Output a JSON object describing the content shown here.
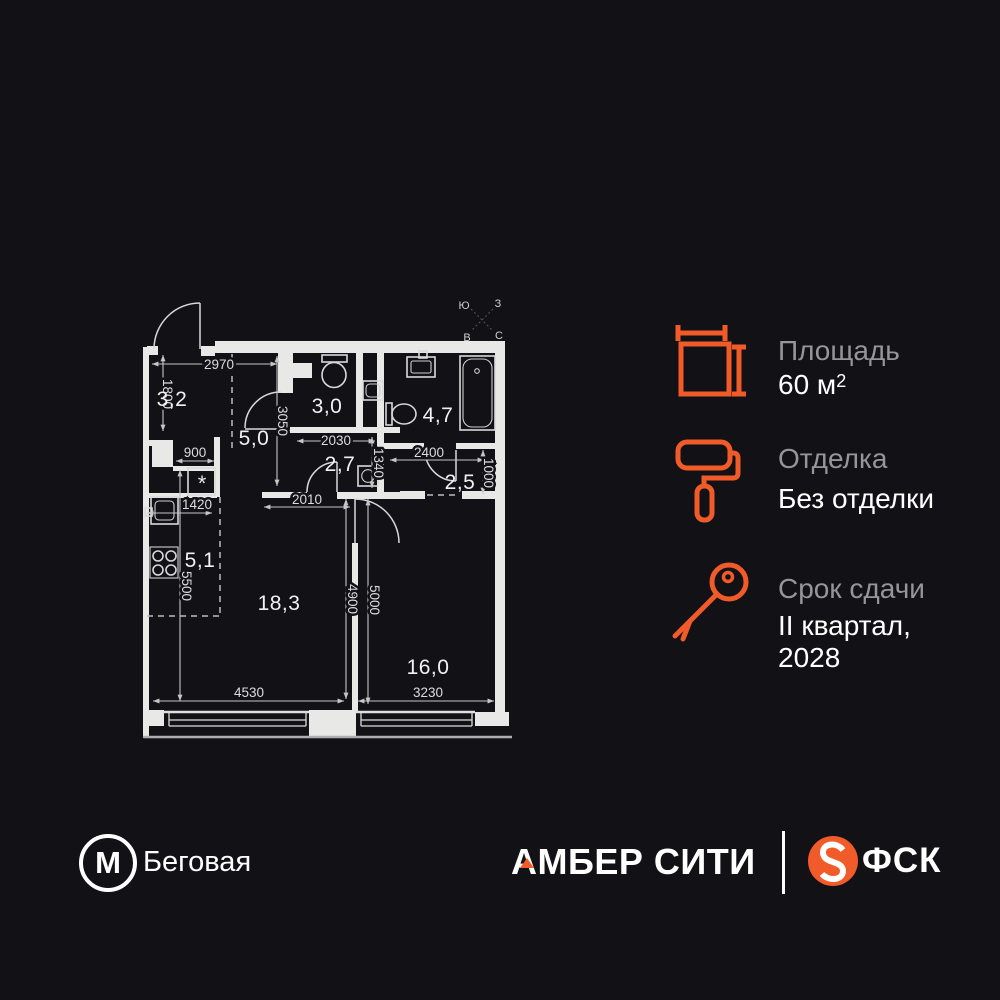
{
  "colors": {
    "accent": "#F15A29",
    "background": "#121116",
    "plan_line": "#E8E8E6",
    "label_gray": "#95959B",
    "text_white": "#FFFFFF"
  },
  "plan": {
    "compass": {
      "top_left": "Ю",
      "top_right": "З",
      "bottom_left": "В",
      "bottom_right": "С"
    },
    "rooms": {
      "entry": "3,2",
      "hallway": "5,0",
      "wc": "3,0",
      "bathroom": "4,7",
      "wardrobe": "2,7",
      "storage": "2,5",
      "kitchen": "5,1",
      "living": "18,3",
      "bedroom": "16,0"
    },
    "dims": {
      "w2970": "2970",
      "h1800": "1800",
      "w900": "900",
      "h3050": "3050",
      "w2030": "2030",
      "h1340": "1340",
      "w2400": "2400",
      "h1000": "1000",
      "w1420": "1420",
      "w2010": "2010",
      "h5500": "5500",
      "h4900": "4900",
      "h5000": "5000",
      "w4530": "4530",
      "w3230": "3230"
    },
    "washer_mark": "*"
  },
  "specs": {
    "area": {
      "label": "Площадь",
      "value": "60 м",
      "value_sup": "2"
    },
    "finish": {
      "label": "Отделка",
      "value": "Без отделки"
    },
    "deadline": {
      "label": "Срок сдачи",
      "value_line1": "II квартал,",
      "value_line2": "2028"
    }
  },
  "footer": {
    "metro_letter": "М",
    "station": "Беговая",
    "project": "АМБЕР СИТИ",
    "developer": "ФСК"
  }
}
